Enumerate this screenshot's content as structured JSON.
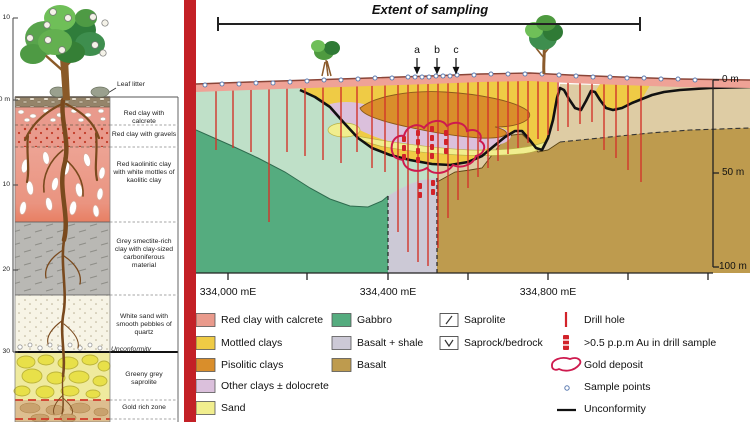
{
  "figure": {
    "divider_color": "#C32026"
  },
  "left_panel": {
    "scale": {
      "above": "10",
      "zero": "0 m",
      "d10": "10",
      "d20": "20",
      "d30": "30"
    },
    "labels": {
      "leaf_litter": "Leaf litter",
      "red_clay_calcrete": "Red clay with calcrete",
      "red_clay_gravels": "Red clay with gravels",
      "red_kaolinitic": "Red kaolinitic clay with white mottles of kaolitic clay",
      "grey_smectite": "Grey smectite-rich clay with clay-sized carboniferous material",
      "white_sand": "White sand with smooth pebbles of quartz",
      "unconformity": "Unconformity",
      "greeny_grey": "Greeny grey saprolite",
      "gold_rich": "Gold rich zone"
    }
  },
  "section": {
    "title": "Extent of sampling",
    "markers": {
      "a": "a",
      "b": "b",
      "c": "c"
    },
    "depth_axis": {
      "d0": "0 m",
      "d50": "50 m",
      "d100": "100 m"
    },
    "easting_axis": {
      "e1": "334,000 mE",
      "e2": "334,400 mE",
      "e3": "334,800 mE"
    }
  },
  "legend": {
    "materials": [
      {
        "label": "Red clay with calcrete",
        "color": "#E99A8C"
      },
      {
        "label": "Mottled clays",
        "color": "#EFCB45"
      },
      {
        "label": "Pisolitic clays",
        "color": "#D98E2B"
      },
      {
        "label": "Other clays ± dolocrete",
        "color": "#DBC0DC"
      },
      {
        "label": "Sand",
        "color": "#F1EE8E"
      },
      {
        "label": "Gabbro",
        "color": "#55AC7F"
      },
      {
        "label": "Basalt + shale",
        "color": "#CCC9D6"
      },
      {
        "label": "Basalt",
        "color": "#BE9B4E"
      }
    ],
    "patterns": [
      {
        "label": "Saprolite"
      },
      {
        "label": "Saprock/bedrock"
      }
    ],
    "symbols": [
      {
        "label": "Drill hole",
        "color": "#D2232A"
      },
      {
        "label": ">0.5 p.p.m Au in drill sample",
        "color": "#D2232A"
      },
      {
        "label": "Gold deposit",
        "color": "#CE1A4E"
      },
      {
        "label": "Sample points",
        "color": "#5A7AB0"
      },
      {
        "label": "Unconformity",
        "color": "#111111"
      }
    ]
  }
}
